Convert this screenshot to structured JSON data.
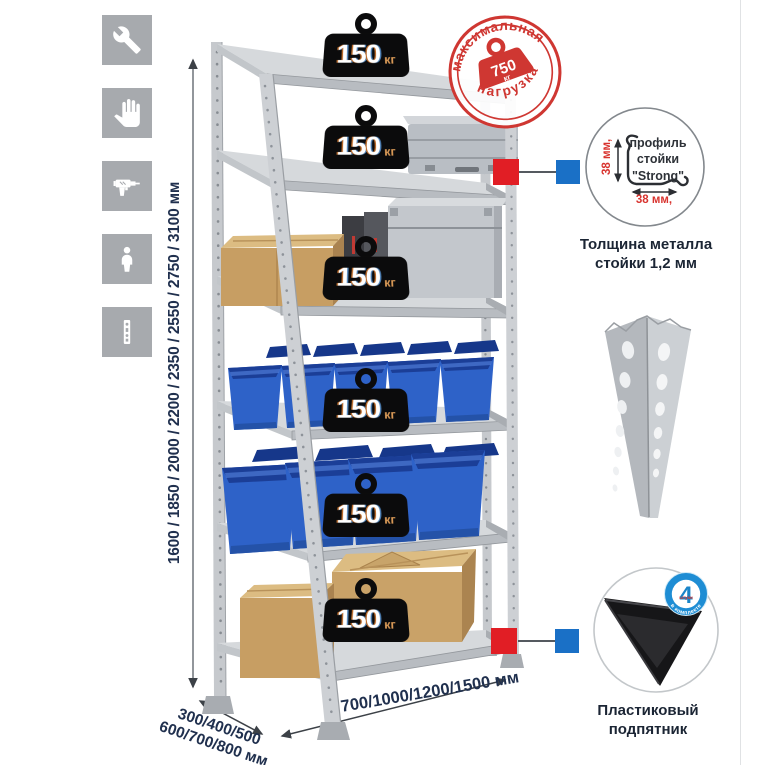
{
  "shelf_badges": {
    "value": "150",
    "unit": "кг"
  },
  "stamp": {
    "arc_top": "максимальная",
    "arc_bottom": "нагрузка",
    "value": "750",
    "unit": "кг"
  },
  "dimensions": {
    "height": "1600 / 1850 / 2000 / 2200 / 2350 / 2550 / 2750 / 3100 мм",
    "depth_line1": "300/400/500",
    "depth_line2": "600/700/800 мм",
    "width": "700/1000/1200/1500 мм"
  },
  "profile_detail": {
    "label_line1": "профиль",
    "label_line2": "стойки",
    "label_line3": "\"Strong\"",
    "dim_vertical": "38 мм,",
    "dim_horizontal": "38 мм,",
    "caption_line1": "Толщина металла",
    "caption_line2": "стойки 1,2 мм"
  },
  "foot_detail": {
    "badge_number": "4",
    "badge_text_small": "штуки",
    "badge_arc": "в комплекте",
    "caption_line1": "Пластиковый",
    "caption_line2": "подпятник"
  },
  "colors": {
    "accent_red": "#cf3732",
    "marker_red": "#e11e25",
    "marker_blue": "#1a70c6",
    "badge_blue": "#1e8dd4",
    "bin_blue": "#2e62c8",
    "metal_gray": "#c9ccd0",
    "text_navy": "#20304e",
    "weight_black": "#0b0b0c"
  },
  "icons": [
    {
      "name": "wrench-icon"
    },
    {
      "name": "gloves-icon"
    },
    {
      "name": "drill-icon"
    },
    {
      "name": "person-icon"
    },
    {
      "name": "upright-post-icon"
    }
  ]
}
